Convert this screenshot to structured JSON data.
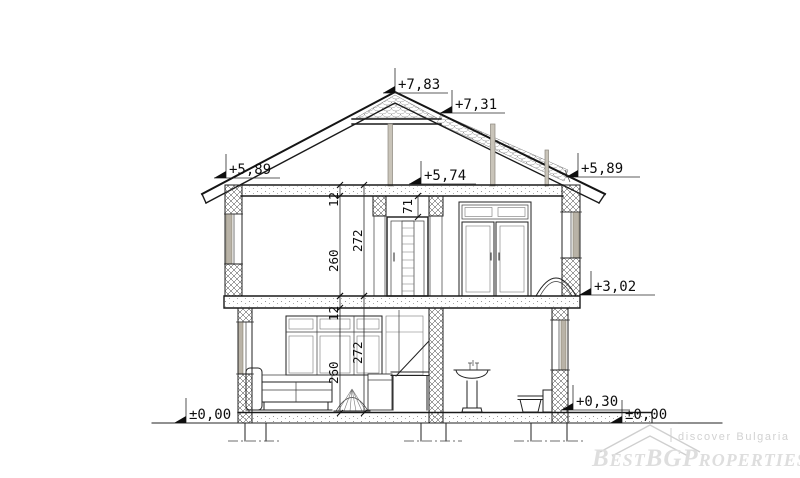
{
  "drawing": {
    "kind": "house-cross-section",
    "levels": {
      "ridge": "+7,83",
      "collar": "+7,31",
      "eave_left": "+5,89",
      "ceiling": "+5,74",
      "eave_right": "+5,89",
      "upper_floor": "+3,02",
      "ground_floor": "+0,30",
      "grade_right": "±0,00",
      "grade_left": "±0,00"
    },
    "dims": {
      "upper_slab": "12",
      "upper_clear": "260",
      "upper_storey": "272",
      "door_head": "71",
      "ground_slab": "12",
      "ground_clear": "260",
      "ground_storey": "272"
    }
  },
  "watermark": {
    "tagline": "discover Bulgaria",
    "brand": "BestBGProperties",
    "logo_color": "#cfcfcf",
    "tag_color": "#d2d2d2",
    "brand_color": "#dedede"
  },
  "colors": {
    "window_fill": "#b9b3a7",
    "post_fill": "#c9c4b9"
  }
}
